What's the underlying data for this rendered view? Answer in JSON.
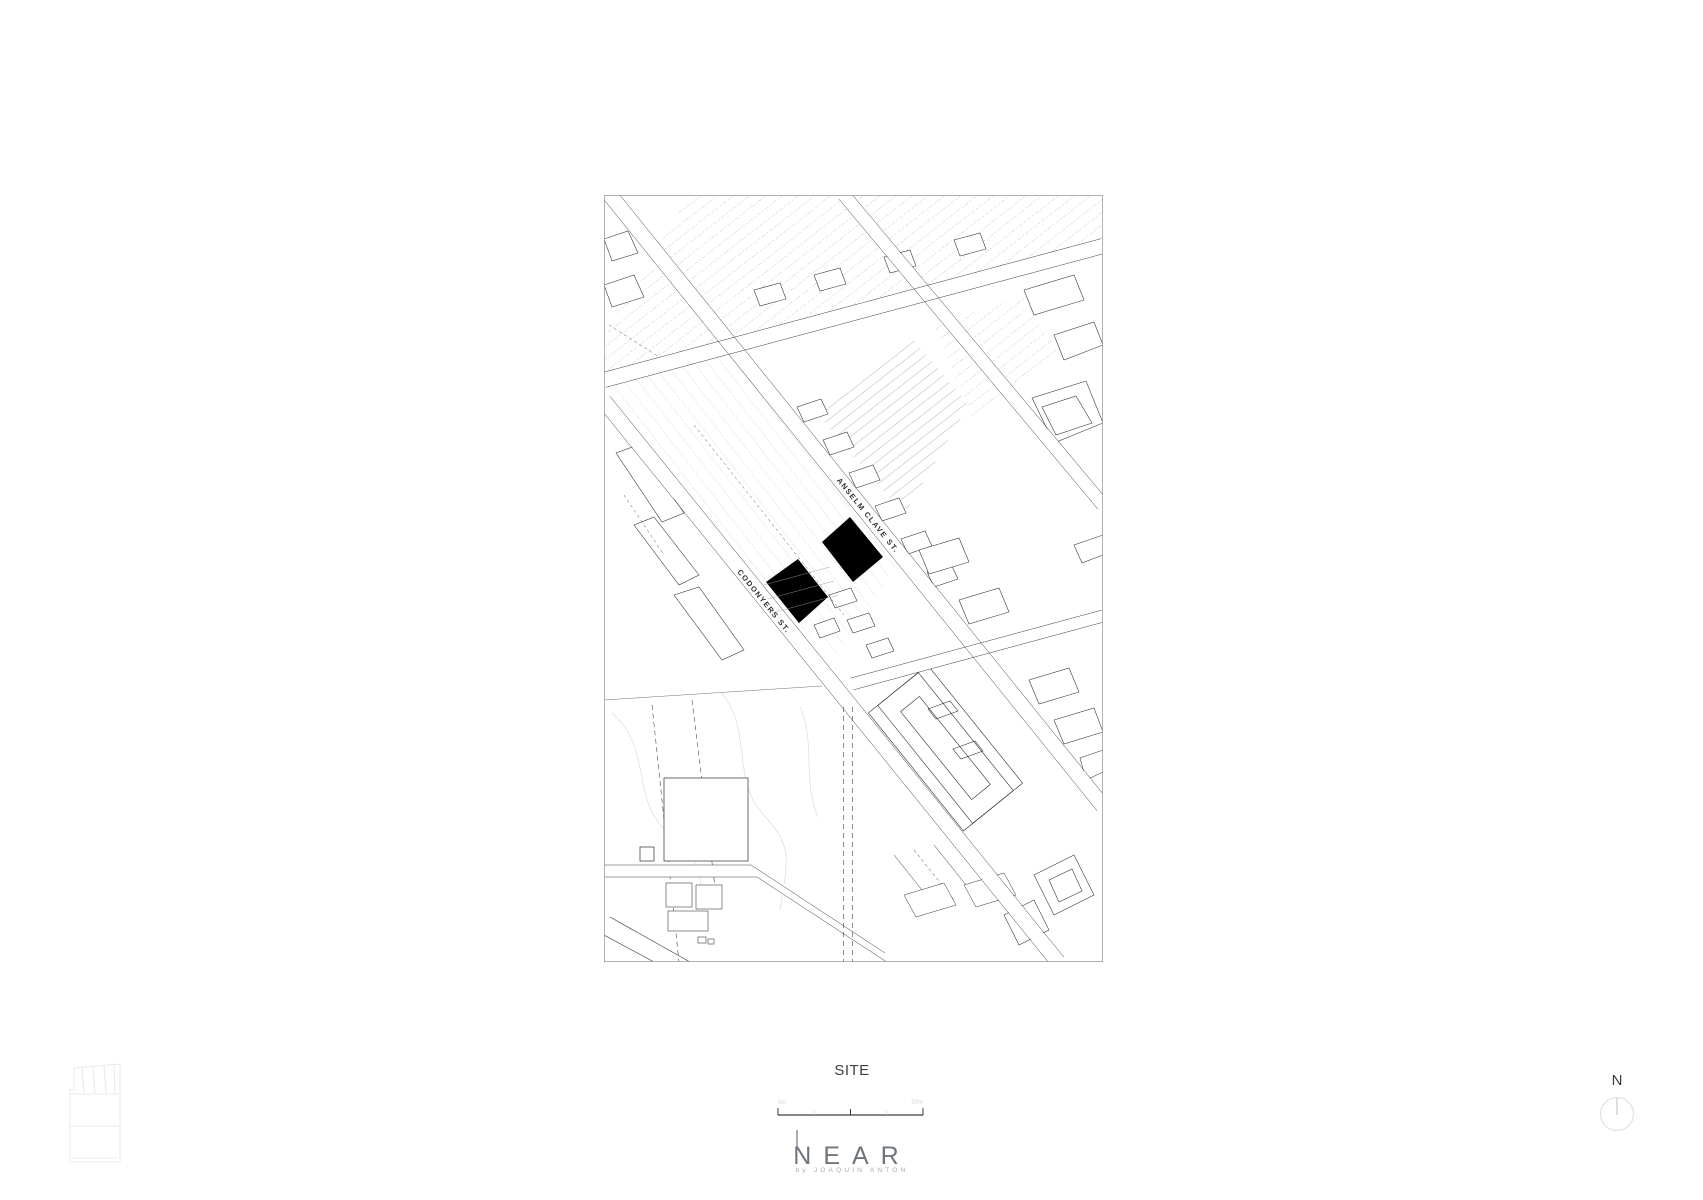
{
  "caption": {
    "site_label": "SITE"
  },
  "map": {
    "street_anselm": "ANSELM CLAVE ST.",
    "street_codonyers": "CODONYERS ST."
  },
  "scale_bar": {
    "label_left": "0m",
    "label_right": "50m"
  },
  "logo": {
    "wordmark": "NEAR",
    "byline": "by JOAQUIN ANTON"
  },
  "north": {
    "label": "N"
  },
  "colors": {
    "ink": "#2e2e2e",
    "light_parcel": "#cccccc",
    "site_fill": "#000000",
    "faint_icon": "#e8e8e8",
    "logo_gray": "#6e757c"
  }
}
